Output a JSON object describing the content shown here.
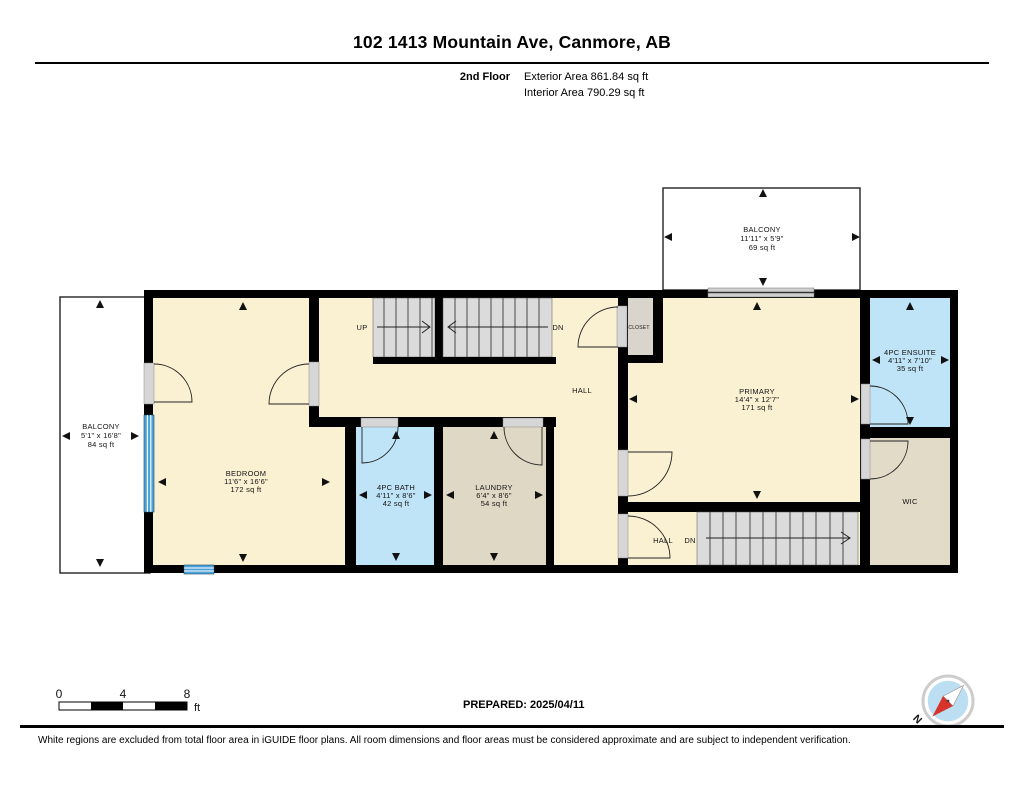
{
  "header": {
    "title": "102 1413 Mountain Ave, Canmore, AB",
    "floor_label": "2nd Floor",
    "exterior_area": "Exterior Area 861.84 sq ft",
    "interior_area": "Interior Area 790.29 sq ft"
  },
  "rooms": {
    "balcony_top": {
      "name": "BALCONY",
      "dims": "11'11\" x 5'9\"",
      "area": "69 sq ft"
    },
    "balcony_left": {
      "name": "BALCONY",
      "dims": "5'1\" x 16'8\"",
      "area": "84 sq ft"
    },
    "bedroom": {
      "name": "BEDROOM",
      "dims": "11'6\" x 16'6\"",
      "area": "172 sq ft"
    },
    "bath": {
      "name": "4PC BATH",
      "dims": "4'11\" x 8'6\"",
      "area": "42 sq ft"
    },
    "laundry": {
      "name": "LAUNDRY",
      "dims": "6'4\" x 8'6\"",
      "area": "54 sq ft"
    },
    "primary": {
      "name": "PRIMARY",
      "dims": "14'4\" x 12'7\"",
      "area": "171 sq ft"
    },
    "ensuite": {
      "name": "4PC ENSUITE",
      "dims": "4'11\" x 7'10\"",
      "area": "35 sq ft"
    },
    "wic": {
      "name": "WIC"
    },
    "closet": {
      "name": "CLOSET"
    },
    "hall": {
      "name": "HALL"
    },
    "hall_lower": {
      "name": "HALL"
    }
  },
  "stairs": {
    "up_label": "UP",
    "dn_label": "DN",
    "dn_lower_label": "DN"
  },
  "scale_bar": {
    "t0": "0",
    "t4": "4",
    "t8": "8",
    "unit": "ft"
  },
  "compass": {
    "north_label": "N"
  },
  "footer": {
    "prepared": "PREPARED: 2025/04/11",
    "disclaimer": "White regions are excluded from total floor area in iGUIDE floor plans. All room dimensions and floor areas must be considered approximate and are subject to independent verification."
  },
  "colors": {
    "room_cream": "#FAF0D2",
    "room_blue": "#BFE3F7",
    "room_tan": "#DFD8C4",
    "closet_gray": "#D9D5CD",
    "stairs_gray": "#DBDBDB",
    "wall_black": "#000000",
    "window_blue": "#4FA3D8",
    "compass_red": "#D6332A",
    "compass_blue": "#BCDEF2"
  }
}
